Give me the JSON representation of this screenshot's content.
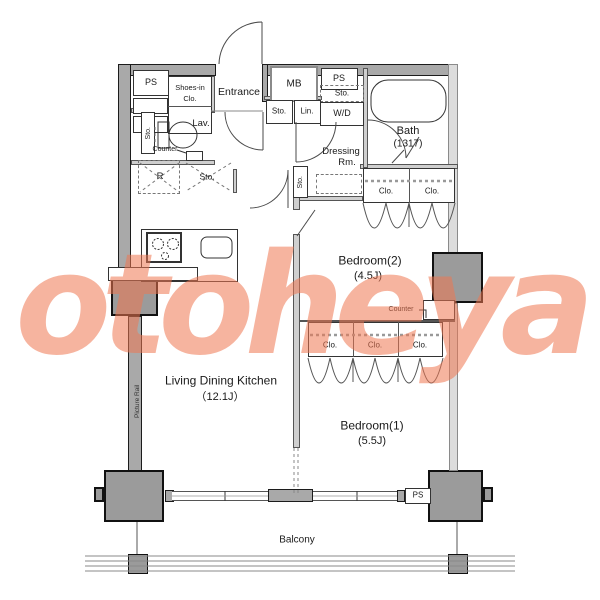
{
  "plan": {
    "watermark": "otoheya",
    "rooms": {
      "ldk": {
        "name": "Living Dining Kitchen",
        "size": "（12.1J）"
      },
      "bedroom1": {
        "name": "Bedroom(1)",
        "size": "(5.5J)"
      },
      "bedroom2": {
        "name": "Bedroom(2)",
        "size": "(4.5J)"
      },
      "bath": {
        "name": "Bath",
        "size": "(1317)"
      },
      "entrance": "Entrance",
      "dressing": {
        "line1": "Dressing",
        "line2": "Rm."
      },
      "balcony": "Balcony"
    },
    "fixtures": {
      "ps": "PS",
      "mb": "MB",
      "wd": "W/D",
      "lin": "Lin.",
      "sto": "Sto.",
      "clo": "Clo.",
      "shoes_line1": "Shoes-in",
      "shoes_line2": "Clo.",
      "lav": "Lav.",
      "counter": "Counter",
      "fridge": "R",
      "picture_rail": "Picture Rail"
    },
    "colors": {
      "wall_gray": "#a9a9a9",
      "column_gray": "#9b9b9b",
      "line_dark": "#1c1c1c",
      "watermark_salmon": "#ef7752"
    }
  }
}
